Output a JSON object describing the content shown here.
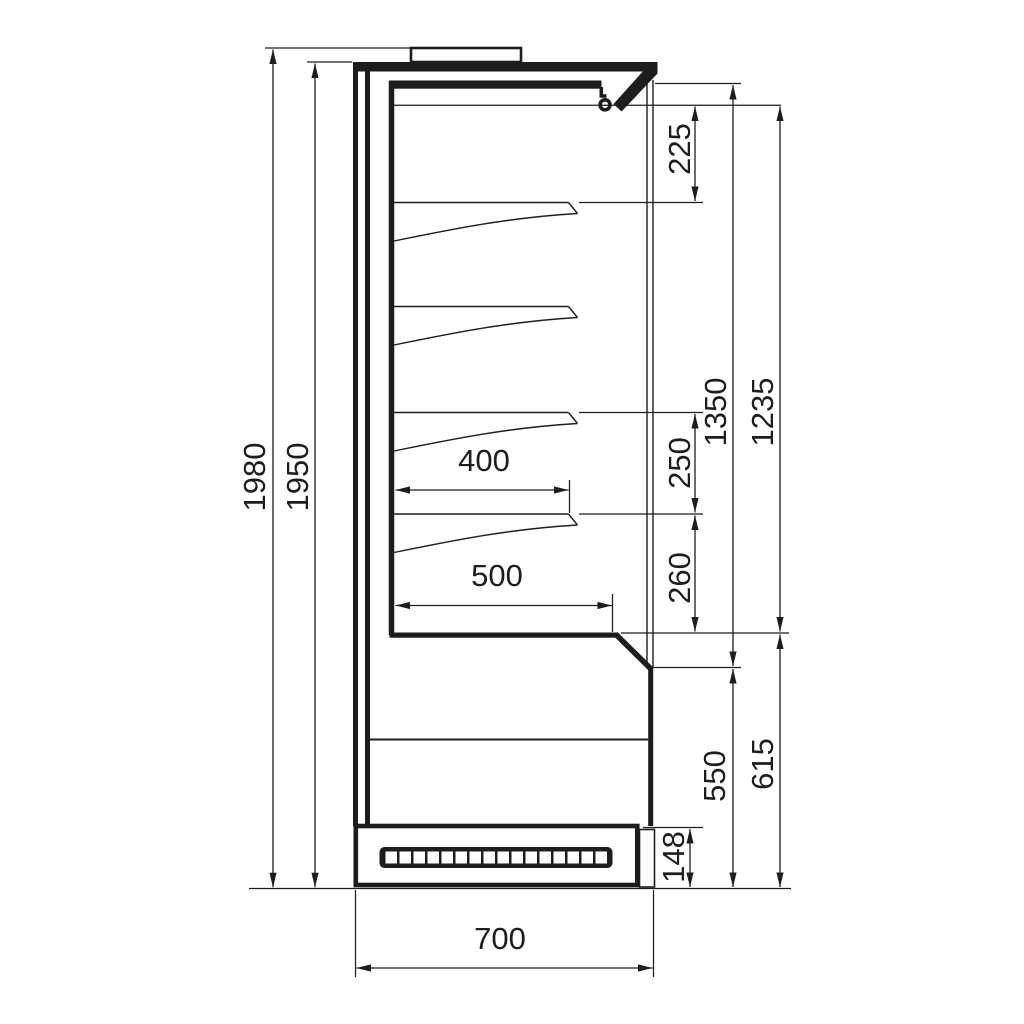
{
  "drawing": {
    "view": "side-section",
    "dimensions": {
      "overall_height": "1980",
      "body_height": "1950",
      "canopy_clearance": "225",
      "shelf_spacing_upper": "250",
      "shelf_spacing_lower": "260",
      "opening_height": "1350",
      "interior_height": "1235",
      "shelf_depth": "400",
      "base_shelf_depth": "500",
      "base_height_inner": "550",
      "base_height_outer": "615",
      "plinth_height": "148",
      "overall_depth": "700"
    },
    "grille": {
      "slot_count": 16
    },
    "line_color": "#1d1d1d",
    "background_color": "#ffffff"
  }
}
